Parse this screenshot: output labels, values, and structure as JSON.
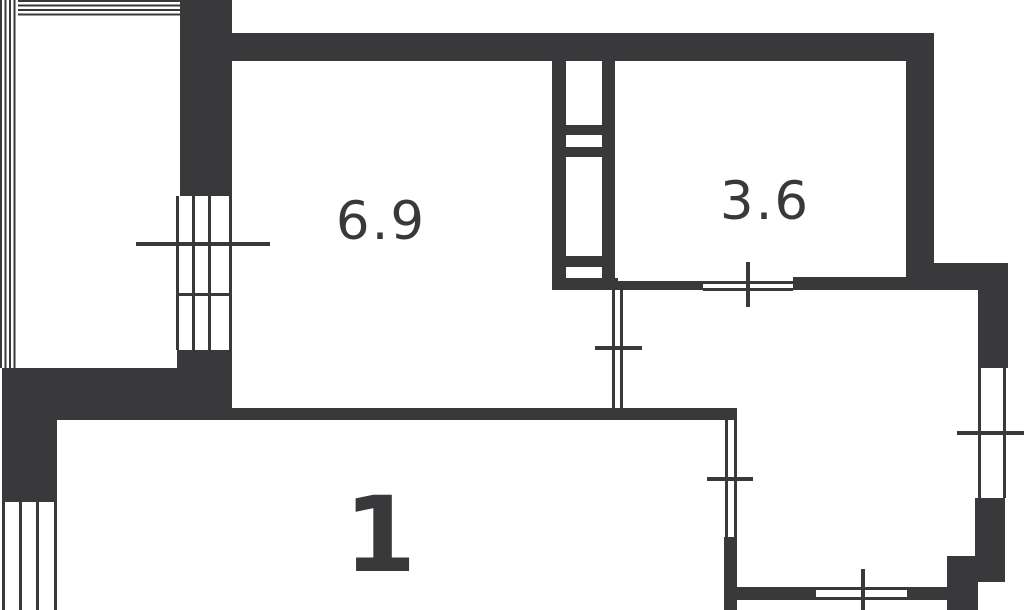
{
  "plan": {
    "kind": "apartment-floor-plan"
  },
  "colors": {
    "wall_dark": "#39393b",
    "background": "#ffffff",
    "label_text": "#39393b"
  },
  "rooms": {
    "room_69": {
      "label": "6.9"
    },
    "room_36": {
      "label": "3.6"
    },
    "room_1": {
      "label": "1"
    }
  }
}
